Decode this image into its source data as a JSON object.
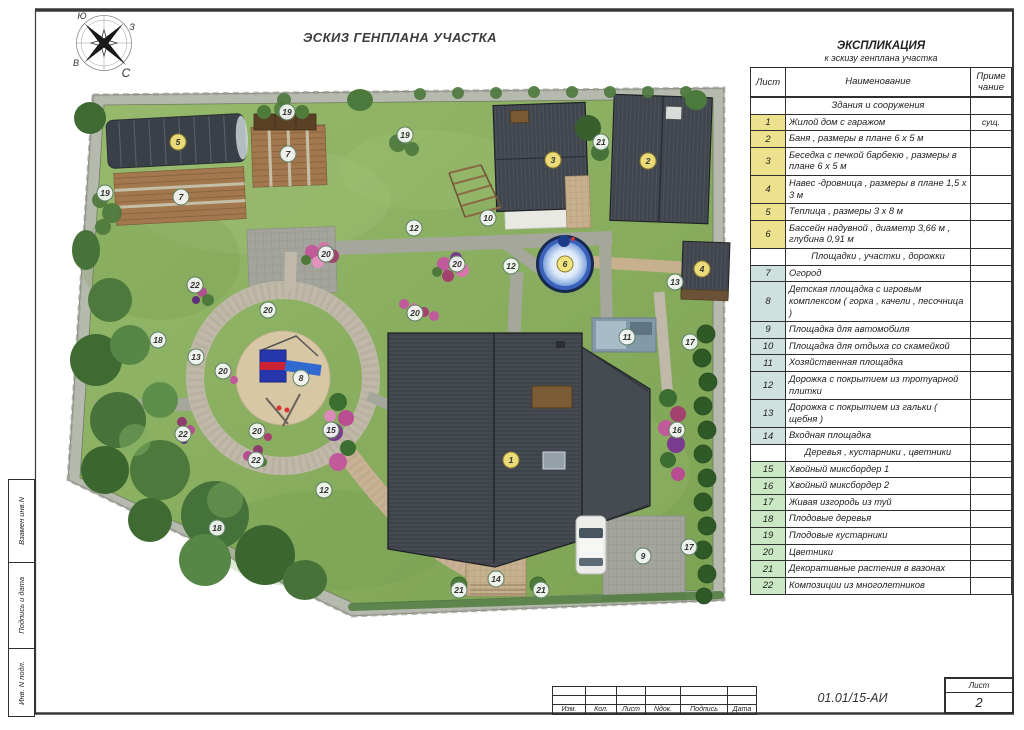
{
  "sheet": {
    "title": "ЭСКИЗ ГЕНПЛАНА УЧАСТКА"
  },
  "compass": {
    "nw": "Ю",
    "ne": "З",
    "sw": "В",
    "se": "С"
  },
  "legend": {
    "title": "ЭКСПЛИКАЦИЯ",
    "subtitle": "к эскизу генплана участка",
    "col_sheet": "Лист",
    "col_name": "Наименование",
    "col_note_line1": "Приме",
    "col_note_line2": "чание",
    "sections": [
      {
        "header": "Здания и сооружения",
        "rows": [
          {
            "num": "1",
            "name": "Жилой дом с гаражом",
            "note": "сущ."
          },
          {
            "num": "2",
            "name": "Баня , размеры в плане 6 х 5 м",
            "note": ""
          },
          {
            "num": "3",
            "name": "Беседка с печкой барбекю , размеры в плане 6 х 5 м",
            "note": ""
          },
          {
            "num": "4",
            "name": "Навес -дровница , размеры в плане 1,5 х 3 м",
            "note": ""
          },
          {
            "num": "5",
            "name": "Теплица , размеры 3 х 8 м",
            "note": ""
          },
          {
            "num": "6",
            "name": "Бассейн надувной , диаметр 3,66 м , глубина 0,91 м",
            "note": ""
          }
        ]
      },
      {
        "header": "Площадки , участки , дорожки",
        "rows": [
          {
            "num": "7",
            "name": "Огород",
            "note": ""
          },
          {
            "num": "8",
            "name": "Детская площадка с игровым комплексом ( горка , качели , песочница )",
            "note": ""
          },
          {
            "num": "9",
            "name": "Площадка для автомобиля",
            "note": ""
          },
          {
            "num": "10",
            "name": "Площадка для отдыха со скамейкой",
            "note": ""
          },
          {
            "num": "11",
            "name": "Хозяйственная площадка",
            "note": ""
          },
          {
            "num": "12",
            "name": "Дорожка с покрытием из тротуарной плитки",
            "note": ""
          },
          {
            "num": "13",
            "name": "Дорожка с покрытием из гальки ( щебня )",
            "note": ""
          },
          {
            "num": "14",
            "name": "Входная площадка",
            "note": ""
          }
        ]
      },
      {
        "header": "Деревья , кустарники , цветники",
        "rows": [
          {
            "num": "15",
            "name": "Хвойный миксбордер 1",
            "note": ""
          },
          {
            "num": "16",
            "name": "Хвойный миксбордер 2",
            "note": ""
          },
          {
            "num": "17",
            "name": "Живая изгородь из туй",
            "note": ""
          },
          {
            "num": "18",
            "name": "Плодовые деревья",
            "note": ""
          },
          {
            "num": "19",
            "name": "Плодовые кустарники",
            "note": ""
          },
          {
            "num": "20",
            "name": "Цветники",
            "note": ""
          },
          {
            "num": "21",
            "name": "Декоративные растения в вазонах",
            "note": ""
          },
          {
            "num": "22",
            "name": "Композиции из многолетников",
            "note": ""
          }
        ]
      }
    ]
  },
  "title_block": {
    "doc_number": "01.01/15-АИ",
    "sheet_label": "Лист",
    "sheet_number": "2",
    "columns": [
      "Изм.",
      "Кол.",
      "Лист",
      "Nдок.",
      "Подпись",
      "Дата"
    ],
    "side_labels": [
      "Взамен инв.N",
      "Подпись и дата",
      "Инв. N подл."
    ]
  },
  "colors": {
    "lawn": "#8FB164",
    "stone_border": "#B6B9AE",
    "roof": "#3F434A",
    "pool_blue": "#3A62BD",
    "path_gray": "#A5A69C",
    "path_gravel": "#C0B8A8",
    "path_tile": "#C6B08E",
    "marker_buildings": "#F2E27A",
    "legend_row_buildings": "#EDE18D",
    "legend_row_areas": "#CFE1DE",
    "legend_row_plants": "#CBE8C4",
    "flower_pink": "#C05A9A"
  },
  "plan": {
    "markers": [
      {
        "n": 1,
        "x": 511,
        "y": 460
      },
      {
        "n": 2,
        "x": 648,
        "y": 161
      },
      {
        "n": 3,
        "x": 553,
        "y": 160
      },
      {
        "n": 4,
        "x": 702,
        "y": 269
      },
      {
        "n": 5,
        "x": 178,
        "y": 142
      },
      {
        "n": 6,
        "x": 565,
        "y": 264
      },
      {
        "n": 7,
        "x": 288,
        "y": 154
      },
      {
        "n": 7,
        "x": 181,
        "y": 197
      },
      {
        "n": 8,
        "x": 301,
        "y": 378
      },
      {
        "n": 9,
        "x": 643,
        "y": 556
      },
      {
        "n": 10,
        "x": 488,
        "y": 218
      },
      {
        "n": 11,
        "x": 627,
        "y": 337
      },
      {
        "n": 12,
        "x": 414,
        "y": 228
      },
      {
        "n": 12,
        "x": 511,
        "y": 266
      },
      {
        "n": 12,
        "x": 324,
        "y": 490
      },
      {
        "n": 13,
        "x": 675,
        "y": 282
      },
      {
        "n": 13,
        "x": 196,
        "y": 357
      },
      {
        "n": 14,
        "x": 496,
        "y": 579
      },
      {
        "n": 15,
        "x": 331,
        "y": 430
      },
      {
        "n": 16,
        "x": 677,
        "y": 430
      },
      {
        "n": 17,
        "x": 690,
        "y": 342
      },
      {
        "n": 17,
        "x": 689,
        "y": 547
      },
      {
        "n": 18,
        "x": 158,
        "y": 340
      },
      {
        "n": 18,
        "x": 217,
        "y": 528
      },
      {
        "n": 19,
        "x": 287,
        "y": 112
      },
      {
        "n": 19,
        "x": 105,
        "y": 193
      },
      {
        "n": 19,
        "x": 405,
        "y": 135
      },
      {
        "n": 20,
        "x": 326,
        "y": 254
      },
      {
        "n": 20,
        "x": 457,
        "y": 264
      },
      {
        "n": 20,
        "x": 268,
        "y": 310
      },
      {
        "n": 20,
        "x": 223,
        "y": 371
      },
      {
        "n": 20,
        "x": 257,
        "y": 431
      },
      {
        "n": 20,
        "x": 415,
        "y": 313
      },
      {
        "n": 21,
        "x": 601,
        "y": 142
      },
      {
        "n": 21,
        "x": 459,
        "y": 590
      },
      {
        "n": 21,
        "x": 541,
        "y": 590
      },
      {
        "n": 22,
        "x": 195,
        "y": 285
      },
      {
        "n": 22,
        "x": 183,
        "y": 434
      },
      {
        "n": 22,
        "x": 256,
        "y": 460
      }
    ]
  }
}
